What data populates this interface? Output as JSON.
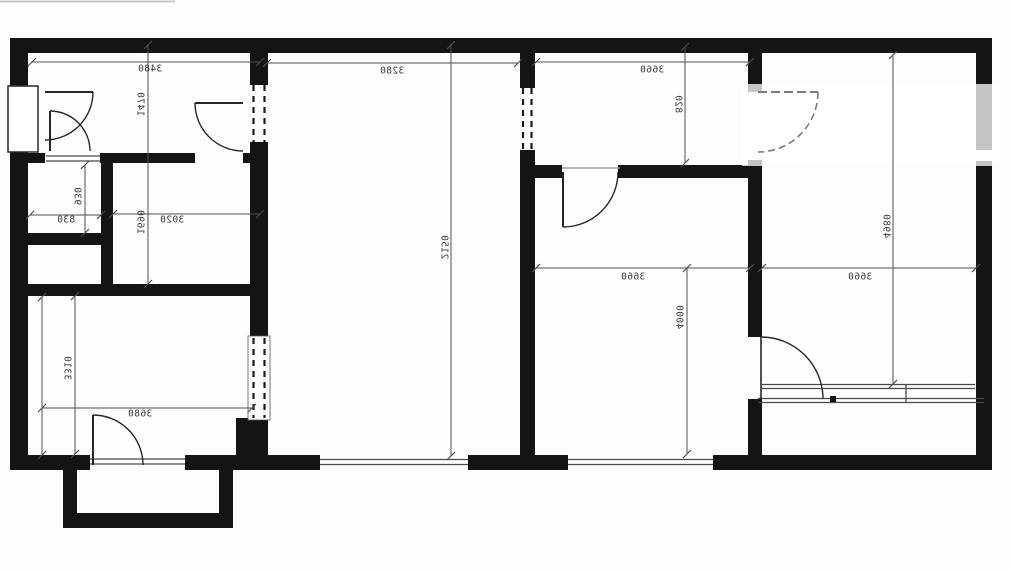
{
  "plan": {
    "type": "apartment-floor-plan",
    "text_style": "mirrored-scan",
    "colors": {
      "wall": "#141414",
      "dim_line": "#4f4f4f",
      "sill": "#5f5f5f",
      "door": "#262626",
      "faded_door": "#7a7a7a",
      "label": "#3c3c3c",
      "background": "#fdfdfd",
      "overlay": "rgba(255,255,255,0.75)"
    },
    "labels": [
      {
        "text": "3480",
        "x": 150,
        "y": 69,
        "v": false
      },
      {
        "text": "1470",
        "x": 140,
        "y": 104,
        "v": true
      },
      {
        "text": "930",
        "x": 77,
        "y": 196,
        "v": true
      },
      {
        "text": "830",
        "x": 66,
        "y": 220,
        "v": false
      },
      {
        "text": "3020",
        "x": 172,
        "y": 220,
        "v": false
      },
      {
        "text": "1690",
        "x": 140,
        "y": 222,
        "v": true
      },
      {
        "text": "3280",
        "x": 392,
        "y": 71,
        "v": false
      },
      {
        "text": "2150",
        "x": 444,
        "y": 247,
        "v": true
      },
      {
        "text": "3660",
        "x": 652,
        "y": 70,
        "v": false
      },
      {
        "text": "820",
        "x": 678,
        "y": 104,
        "v": true
      },
      {
        "text": "3660",
        "x": 633,
        "y": 277,
        "v": false
      },
      {
        "text": "4000",
        "x": 679,
        "y": 317,
        "v": true
      },
      {
        "text": "3660",
        "x": 860,
        "y": 277,
        "v": false
      },
      {
        "text": "4980",
        "x": 886,
        "y": 226,
        "v": true
      },
      {
        "text": "3310",
        "x": 67,
        "y": 368,
        "v": true
      },
      {
        "text": "3680",
        "x": 140,
        "y": 414,
        "v": false
      }
    ],
    "dim_lines": [
      {
        "x1": 32,
        "y1": 62,
        "x2": 260,
        "y2": 62
      },
      {
        "x1": 148,
        "y1": 45,
        "x2": 148,
        "y2": 284
      },
      {
        "x1": 85,
        "y1": 165,
        "x2": 85,
        "y2": 233
      },
      {
        "x1": 30,
        "y1": 215,
        "x2": 101,
        "y2": 215
      },
      {
        "x1": 113,
        "y1": 214,
        "x2": 260,
        "y2": 214
      },
      {
        "x1": 267,
        "y1": 63,
        "x2": 518,
        "y2": 63
      },
      {
        "x1": 451,
        "y1": 45,
        "x2": 451,
        "y2": 456
      },
      {
        "x1": 536,
        "y1": 62,
        "x2": 750,
        "y2": 62
      },
      {
        "x1": 685,
        "y1": 47,
        "x2": 685,
        "y2": 163
      },
      {
        "x1": 536,
        "y1": 268,
        "x2": 750,
        "y2": 268
      },
      {
        "x1": 687,
        "y1": 268,
        "x2": 687,
        "y2": 454
      },
      {
        "x1": 762,
        "y1": 268,
        "x2": 976,
        "y2": 268
      },
      {
        "x1": 893,
        "y1": 55,
        "x2": 893,
        "y2": 384
      },
      {
        "x1": 75,
        "y1": 296,
        "x2": 75,
        "y2": 454
      },
      {
        "x1": 42,
        "y1": 408,
        "x2": 252,
        "y2": 408
      },
      {
        "x1": 42,
        "y1": 297,
        "x2": 42,
        "y2": 455
      }
    ]
  }
}
